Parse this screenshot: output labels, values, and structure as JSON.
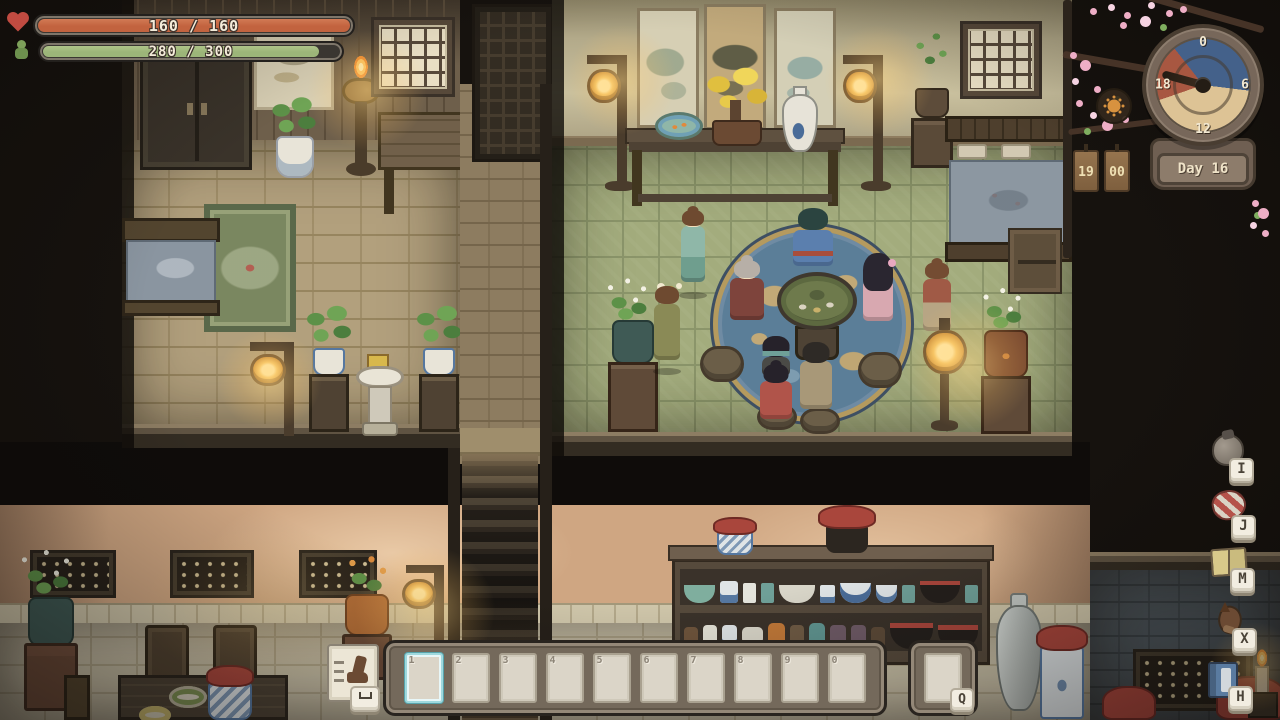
{
  "hud": {
    "health": {
      "icon": "heart-icon",
      "current": 160,
      "max": 160,
      "label": "160 / 160"
    },
    "stamina": {
      "icon": "sprout-icon",
      "current": 280,
      "max": 300,
      "label": "280 / 300"
    },
    "clock": {
      "day_label": "Day 16",
      "hour_tag": "19",
      "minute_tag": "00",
      "dial_numbers": [
        "0",
        "6",
        "12",
        "18"
      ],
      "phase_icon": "sun-icon"
    },
    "hotkeys": [
      {
        "icon": "inventory-bag-icon",
        "key": "I"
      },
      {
        "icon": "journal-bundle-icon",
        "key": "J"
      },
      {
        "icon": "map-book-icon",
        "key": "M"
      },
      {
        "icon": "horse-icon",
        "key": "X"
      },
      {
        "icon": "handbook-icon",
        "key": "H"
      }
    ],
    "hotbar": {
      "slots": [
        "1",
        "2",
        "3",
        "4",
        "5",
        "6",
        "7",
        "8",
        "9",
        "0"
      ],
      "selected_index": 0,
      "extra_slot_key": "Q",
      "dash_action": {
        "icon": "boot-icon",
        "key": "space"
      }
    }
  },
  "colors": {
    "health_fill": "#c2633f",
    "stamina_fill": "#9cb579",
    "slot_selected": "#9fd9de",
    "night_segment": "#44618a",
    "day_segment": "#ddc395",
    "dusk_segment": "#a85741"
  }
}
